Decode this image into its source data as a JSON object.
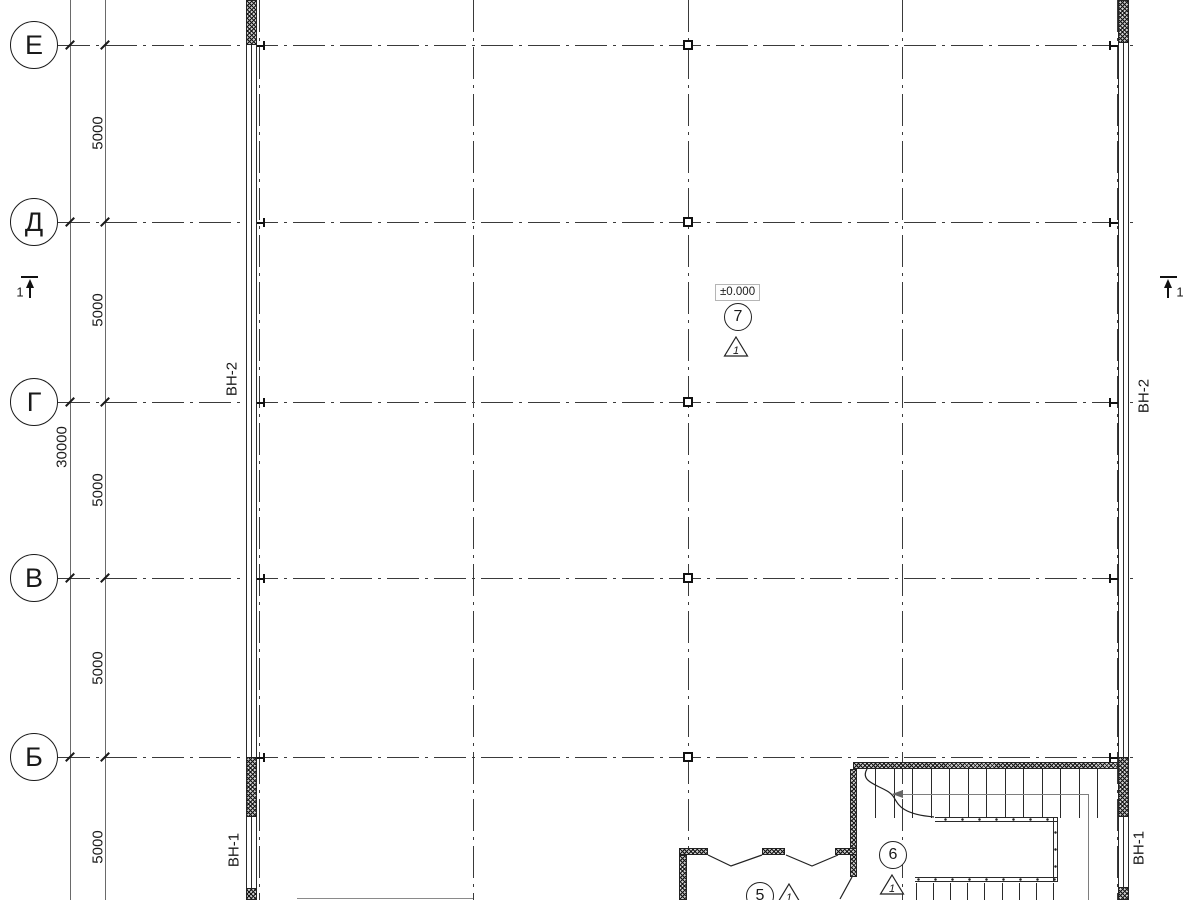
{
  "plan": {
    "axes": [
      {
        "label": "Е"
      },
      {
        "label": "Д"
      },
      {
        "label": "Г"
      },
      {
        "label": "В"
      },
      {
        "label": "Б"
      }
    ],
    "dim_segments": [
      "5000",
      "5000",
      "5000",
      "5000",
      "5000"
    ],
    "dim_total": "30000",
    "level_mark": "±0.000",
    "section_marks": {
      "left": "1",
      "right": "1"
    },
    "wall_marks": {
      "left_upper": "ВН-2",
      "right_upper": "ВН-2",
      "left_lower": "ВН-1",
      "right_lower": "ВН-1"
    },
    "rooms": [
      {
        "number": "7",
        "detail": "1"
      },
      {
        "number": "6",
        "detail": "1"
      },
      {
        "number": "5",
        "detail": "1"
      }
    ],
    "colors": {
      "ink": "#1a1a1a",
      "background": "#ffffff",
      "muted": "#7e7e7e"
    }
  }
}
